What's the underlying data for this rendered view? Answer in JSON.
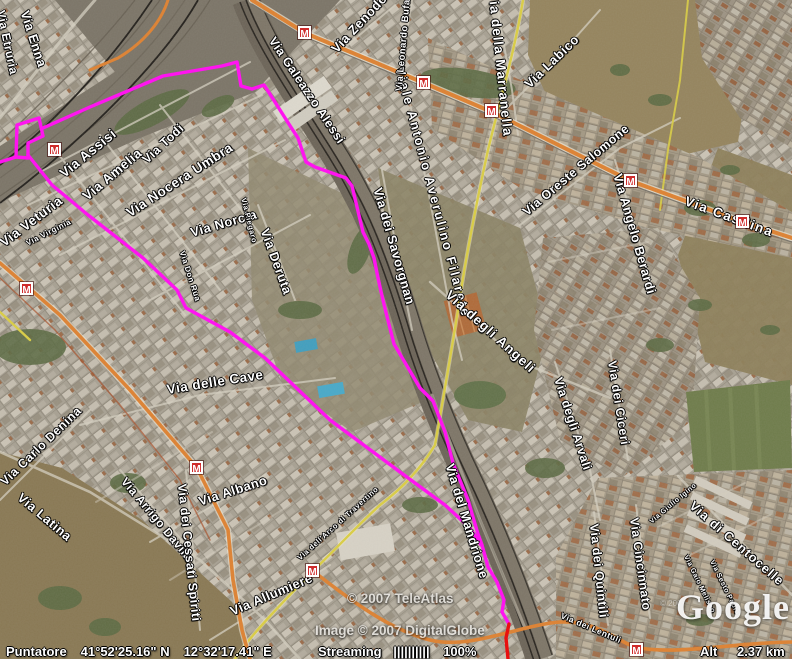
{
  "map": {
    "metro_glyph": "M",
    "colors": {
      "track_primary": "#ff14f0",
      "track_secondary": "#e81010",
      "road_primary": "#e0812f",
      "road_secondary": "#dccf42"
    },
    "labels": [
      {
        "text": "Via Enna"
      },
      {
        "text": "Via Etruria"
      },
      {
        "text": "Via Assisi"
      },
      {
        "text": "Via Amelia"
      },
      {
        "text": "Via Todi"
      },
      {
        "text": "Via Nocera Umbra"
      },
      {
        "text": "Via Norcia"
      },
      {
        "text": "Via Veturia"
      },
      {
        "text": "Via Virginia"
      },
      {
        "text": "Via Deruta"
      },
      {
        "text": "Via Piegaro"
      },
      {
        "text": "Via Don Rua"
      },
      {
        "text": "Via delle Cave"
      },
      {
        "text": "Via dei Savorgnan"
      },
      {
        "text": "Viale Antonio Averulino Filarete"
      },
      {
        "text": "Via degli Angeli"
      },
      {
        "text": "Via Galeazzo Alessi"
      },
      {
        "text": "Via Zenodossio"
      },
      {
        "text": "Via Leonardo Bufalini"
      },
      {
        "text": "Via della Marranella"
      },
      {
        "text": "Via Labico"
      },
      {
        "text": "Via Oreste Salomone"
      },
      {
        "text": "Via Angelo Berardi"
      },
      {
        "text": "Via Casilina"
      },
      {
        "text": "Via dei Ciceri"
      },
      {
        "text": "Via degli Arvali"
      },
      {
        "text": "Via dei Quintili"
      },
      {
        "text": "Via Cincinnato"
      },
      {
        "text": "Via di Centocelle"
      },
      {
        "text": "Via Giulio Igino"
      },
      {
        "text": "Via Gaio Melisso"
      },
      {
        "text": "Via Sesto Papio"
      },
      {
        "text": "Via Carlo Denina"
      },
      {
        "text": "Via Latina"
      },
      {
        "text": "Via Arrigo Davila"
      },
      {
        "text": "Via dei Cessati Spiriti"
      },
      {
        "text": "Via Albano"
      },
      {
        "text": "Via Allumiere"
      },
      {
        "text": "Via dell'Arco di Travertino"
      },
      {
        "text": "Via del Mandrione"
      },
      {
        "text": "Via dei Lentuli"
      }
    ]
  },
  "copyright": {
    "teleatlas": "© 2007 TeleAtlas",
    "digitalglobe": "Image © 2007 DigitalGlobe",
    "small": "© 2007"
  },
  "watermark": {
    "logo": "Google"
  },
  "status": {
    "pointer_label": "Puntatore",
    "pointer_lat": "41°52'25.16\" N",
    "pointer_lon": "12°32'17.41\" E",
    "streaming_label": "Streaming",
    "streaming_bars": "||||||||||",
    "streaming_pct": "100%",
    "alt_label": "Alt",
    "alt_value": "2.37 km"
  }
}
